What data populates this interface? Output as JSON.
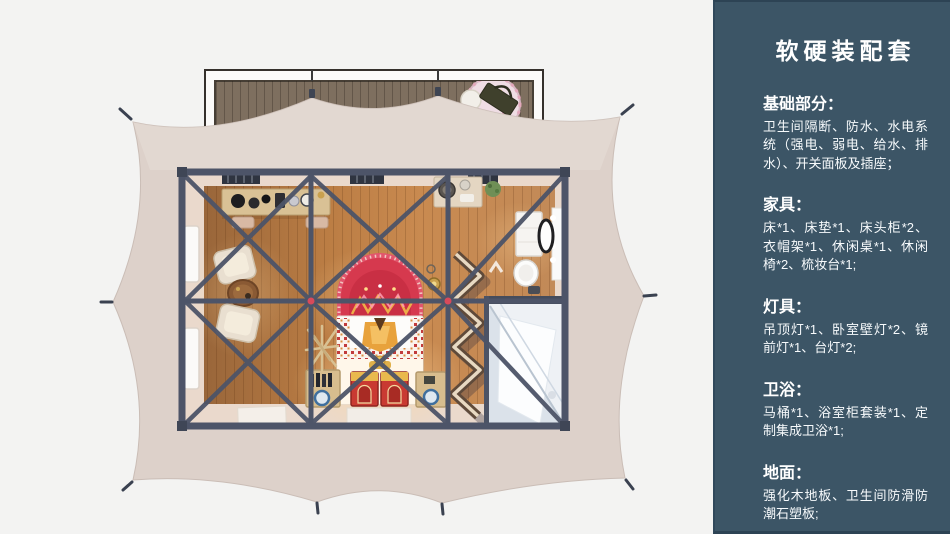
{
  "panel": {
    "title": "软硬装配套",
    "sections": [
      {
        "heading": "基础部分：",
        "body": "卫生间隔断、防水、水电系统（强电、弱电、给水、排水）、开关面板及插座；"
      },
      {
        "heading": "家具：",
        "body": "床*1、床垫*1、床头柜*2、衣帽架*1、休闲桌*1、休闲椅*2、梳妆台*1;"
      },
      {
        "heading": "灯具：",
        "body": "吊顶灯*1、卧室壁灯*2、镜前灯*1、台灯*2;"
      },
      {
        "heading": "卫浴：",
        "body": "马桶*1、浴室柜套装*1、定制集成卫浴*1;"
      },
      {
        "heading": "地面：",
        "body": "强化木地板、卫生间防滑防潮石塑板;"
      }
    ]
  },
  "illustration": {
    "alt": "帐篷客房俯视效果图",
    "colors": {
      "background": "#f3f3f2",
      "panel_bg": "#3c5566",
      "panel_border": "#2d4354",
      "text": "#ffffff",
      "tent_canvas": "#ddd1ca",
      "frame_beam": "#4d5468",
      "wood_floor": "#c08148",
      "deck_wood": "#7e6f5f",
      "bed_arch_red": "#d6394e",
      "bathroom_white": "#eef1f5",
      "joint_red": "#d84a5a"
    }
  }
}
